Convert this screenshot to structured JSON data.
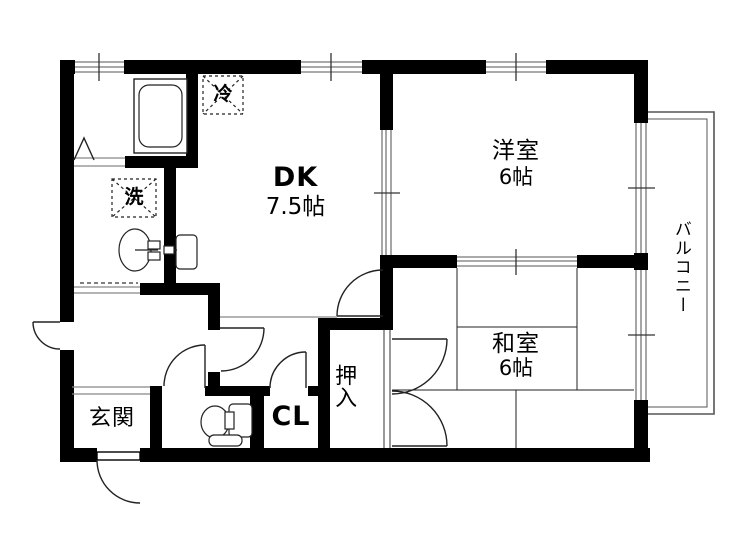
{
  "plan_title": "2DK apartment floor plan",
  "rooms": {
    "dk": {
      "name": "DK",
      "size": "7.5帖"
    },
    "western": {
      "name": "洋室",
      "size": "6帖"
    },
    "japanese": {
      "name": "和室",
      "size": "6帖"
    },
    "entrance": {
      "name": "玄関"
    },
    "closet": {
      "name": "CL"
    },
    "oshiire": {
      "name": "押入"
    },
    "balcony": {
      "name": "バルコニー"
    }
  },
  "fixtures": {
    "refrigerator_mark": "冷",
    "washing_machine_mark": "洗"
  },
  "colors": {
    "wall": "#000000",
    "thin_line": "#222222",
    "window_line": "#777777",
    "background": "#ffffff"
  }
}
